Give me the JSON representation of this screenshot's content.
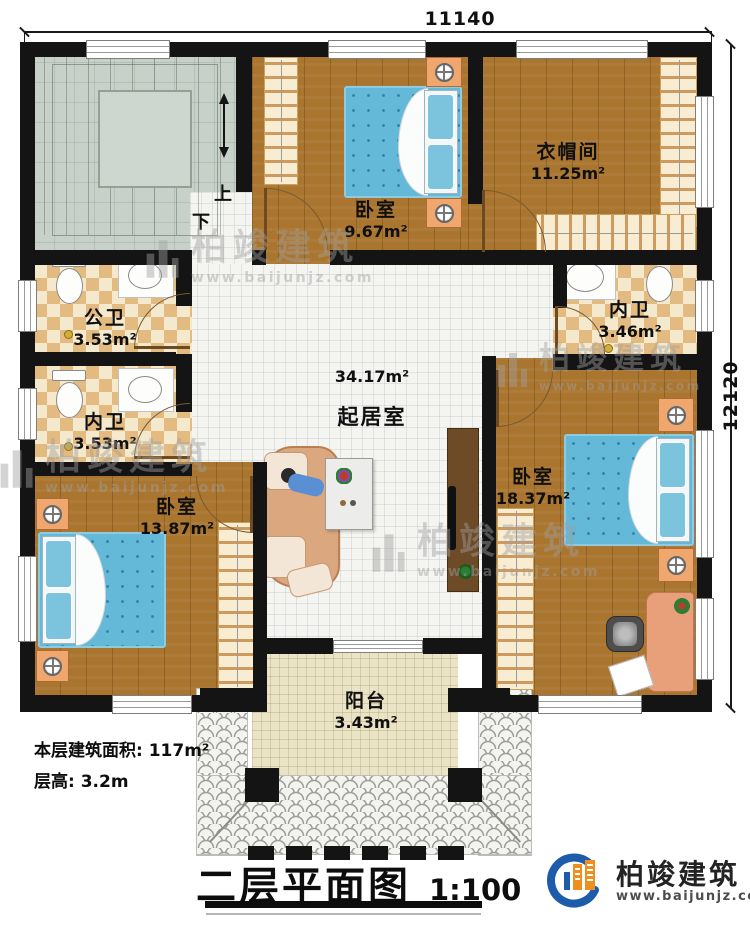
{
  "plan": {
    "dim_top": "11140",
    "dim_right": "12120",
    "stairs": {
      "up": "上",
      "down": "下"
    },
    "rooms": {
      "bedroom_top": {
        "name": "卧室",
        "area": "9.67m²"
      },
      "cloakroom": {
        "name": "衣帽间",
        "area": "11.25m²"
      },
      "public_bath": {
        "name": "公卫",
        "area": "3.53m²"
      },
      "inner_bath_left": {
        "name": "内卫",
        "area": "3.53m²"
      },
      "inner_bath_right": {
        "name": "内卫",
        "area": "3.46m²"
      },
      "living": {
        "name": "起居室",
        "area": "34.17m²"
      },
      "bedroom_left": {
        "name": "卧室",
        "area": "13.87m²"
      },
      "bedroom_right": {
        "name": "卧室",
        "area": "18.37m²"
      },
      "balcony": {
        "name": "阳台",
        "area": "3.43m²"
      }
    }
  },
  "info": {
    "floor_area": "本层建筑面积: 117m²",
    "floor_height": "层高: 3.2m"
  },
  "title": {
    "text": "二层平面图",
    "scale": "1:100"
  },
  "brand": {
    "name": "柏竣建筑",
    "url": "www.baijunjz.com"
  },
  "watermark": {
    "name": "柏竣建筑",
    "url": "www.baijunjz.com"
  },
  "colors": {
    "wall": "#141414",
    "wood": "#a9752f",
    "tile_tan": "#e3ba80",
    "tile_cream": "#f4e9cd",
    "bed_blue": "#64b8d8",
    "brand_blue": "#1d5cab",
    "brand_orange": "#ef8f1f"
  }
}
